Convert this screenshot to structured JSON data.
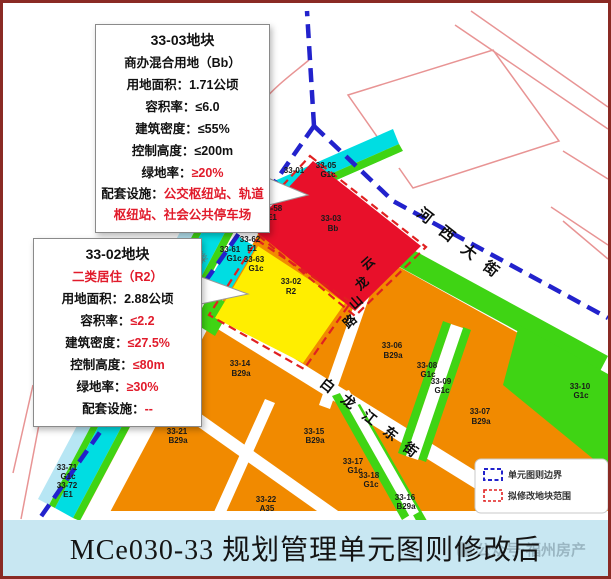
{
  "callouts": [
    {
      "title": "33-03地块",
      "subtitle": "商办混合用地（Bb）",
      "rows": [
        {
          "label": "用地面积：",
          "value": "1.71公顷"
        },
        {
          "label": "容积率：",
          "value": "≤6.0"
        },
        {
          "label": "建筑密度：",
          "value": "≤55%"
        },
        {
          "label": "控制高度：",
          "value": "≤200m"
        },
        {
          "label": "绿地率：",
          "value": "≥20%"
        },
        {
          "label": "配套设施：",
          "value": "公交枢纽站、轨道枢纽站、社会公共停车场"
        }
      ]
    },
    {
      "title": "33-02地块",
      "subtitle": "二类居住（R2）",
      "rows": [
        {
          "label": "用地面积：",
          "value": "2.88公顷"
        },
        {
          "label": "容积率：",
          "value": "≤2.2"
        },
        {
          "label": "建筑密度：",
          "value": "≤27.5%"
        },
        {
          "label": "控制高度：",
          "value": "≤80m"
        },
        {
          "label": "绿地率：",
          "value": "≥30%"
        },
        {
          "label": "配套设施：",
          "value": "--"
        }
      ]
    }
  ],
  "map": {
    "streets": [
      {
        "name": "河西大街"
      },
      {
        "name": "云龙山路"
      },
      {
        "name": "白龙江东街"
      },
      {
        "name": "秦"
      }
    ],
    "parcels": [
      {
        "code": "33-01",
        "cls": ""
      },
      {
        "code": "33-05",
        "cls": "G1c"
      },
      {
        "code": "33-58",
        "cls": "E1"
      },
      {
        "code": "33-62",
        "cls": "E1"
      },
      {
        "code": "33-61",
        "cls": "G1c"
      },
      {
        "code": "33-63",
        "cls": "G1c"
      },
      {
        "code": "33-71",
        "cls": "G1c"
      },
      {
        "code": "33-72",
        "cls": "E1"
      },
      {
        "code": "33-03",
        "cls": "Bb"
      },
      {
        "code": "33-02",
        "cls": "R2"
      },
      {
        "code": "33-14",
        "cls": "B29a"
      },
      {
        "code": "33-06",
        "cls": "B29a"
      },
      {
        "code": "33-08",
        "cls": "G1c"
      },
      {
        "code": "33-09",
        "cls": "G1c"
      },
      {
        "code": "33-07",
        "cls": "B29a"
      },
      {
        "code": "33-10",
        "cls": "G1c"
      },
      {
        "code": "33-15",
        "cls": "B29a"
      },
      {
        "code": "33-21",
        "cls": "B29a"
      },
      {
        "code": "33-17",
        "cls": "G1c"
      },
      {
        "code": "33-18",
        "cls": "G1c"
      },
      {
        "code": "33-22",
        "cls": "A35"
      },
      {
        "code": "33-16",
        "cls": "B29a"
      }
    ],
    "legend": {
      "items": [
        {
          "label": "单元图则边界",
          "color": "#2222cc"
        },
        {
          "label": "拟修改地块范围",
          "color": "#e02020"
        }
      ]
    }
  },
  "caption": {
    "text": "MCe030-33 规划管理单元图则修改后",
    "watermark": "公众号·福州房产"
  },
  "colors": {
    "parcel_red": "#e8102a",
    "parcel_yellow": "#ffee00",
    "parcel_orange": "#f18a00",
    "parcel_green": "#3fd414",
    "parcel_cyan": "#00dde2",
    "water_blue": "#b7e6f4",
    "boundary_blue": "#2222cc",
    "modify_red": "#e02020",
    "caption_bg": "#c8e7f2",
    "frame_border": "#8a2a24"
  }
}
